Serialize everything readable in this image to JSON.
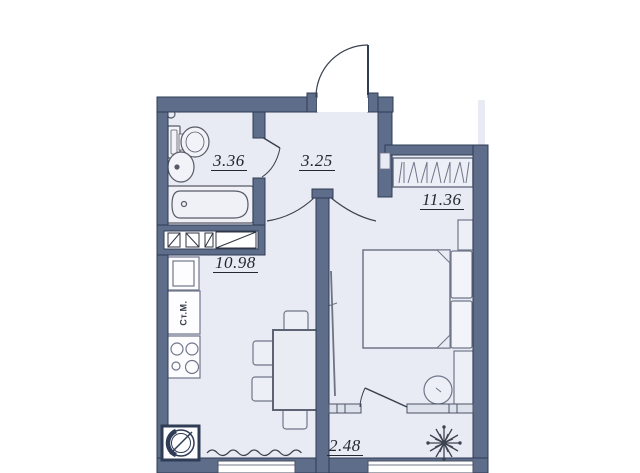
{
  "floor_plan": {
    "rooms": [
      {
        "id": "bathroom",
        "area": "3.36"
      },
      {
        "id": "hallway",
        "area": "3.25"
      },
      {
        "id": "bedroom",
        "area": "11.36"
      },
      {
        "id": "kitchen_living",
        "area": "10.98"
      },
      {
        "id": "balcony",
        "area": "2.48"
      }
    ],
    "appliance_labels": {
      "washing_machine": "Ст.М."
    },
    "colors": {
      "wall_fill": "#5d6d8a",
      "wall_outline": "#2e3c55",
      "floor": "#e9ebf4",
      "furniture_line": "#70768a",
      "label_text": "#23272f",
      "background": "#ffffff"
    },
    "icons": [
      "entry-door-icon",
      "toilet-icon",
      "bathroom-sink-icon",
      "bathtub-icon",
      "towel-ring-icon",
      "vent-shaft-icon",
      "fridge-icon",
      "washing-machine-icon",
      "stove-icon",
      "kitchen-sink-icon",
      "radiator-wave-icon",
      "dining-table-icon",
      "chair-icon",
      "wardrobe-icon",
      "bed-icon",
      "pillow-icon",
      "nightstand-icon",
      "dressing-table-icon",
      "stool-icon",
      "balcony-door-icon",
      "plant-icon",
      "window-icon"
    ]
  }
}
